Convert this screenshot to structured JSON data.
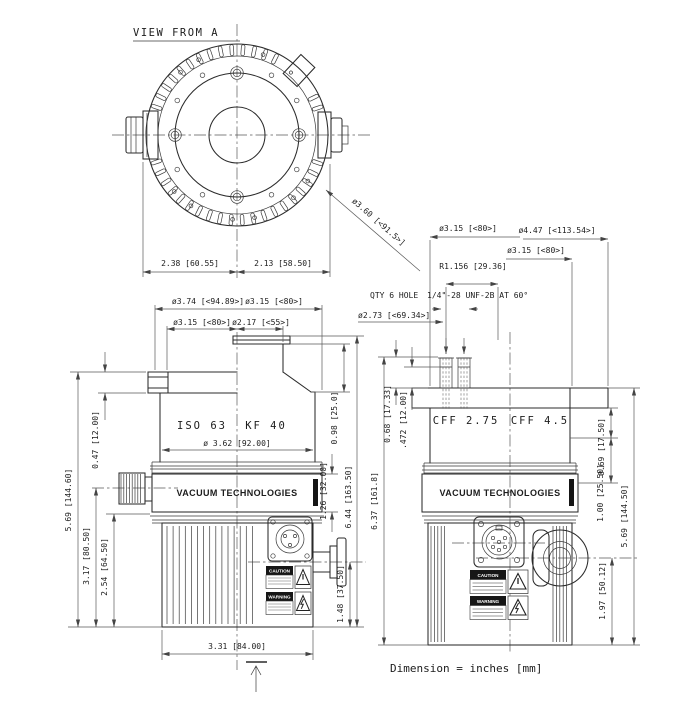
{
  "title": "VIEW FROM A",
  "note": "Dimension = inches [mm]",
  "top_view": {
    "dim_left": "2.38 [60.55]",
    "dim_right": "2.13 [58.50]",
    "dia_leader": "ø3.60 [<91.5>]"
  },
  "left_view": {
    "flange_left": "ISO 63",
    "flange_right": "KF 40",
    "brand": "VACUUM TECHNOLOGIES",
    "dims": {
      "dia_flange_od": "ø3.74 [<94.89>]",
      "dia_neck": "ø3.15 [<80>]",
      "dia_flange_bc": "ø3.15 [<80>]",
      "dia_kf_tube": "ø2.17 [<55>]",
      "dia_body": "ø 3.62 [92.00]",
      "height_total": "5.69 [144.60]",
      "flange_thickness": "0.47 [12.00]",
      "height_vent_port": "3.17 [80.50]",
      "height_motor": "2.54 [64.50]",
      "height_side_port": "1.48 [37.50]",
      "width_base": "3.31 [84.00]",
      "height_neck": "0.98 [25.0]",
      "height_band": "1.26 [32.00]",
      "height_body": "6.44 [163.50]"
    },
    "labels": {
      "caution": "CAUTION",
      "warning": "WARNING"
    }
  },
  "right_view": {
    "flange_left": "CFF 2.75",
    "flange_right": "CFF 4.5",
    "brand": "VACUUM TECHNOLOGIES",
    "dims": {
      "dia_bolt_top": "ø3.15 [<80>]",
      "dia_flange_od": "ø4.47 [<113.54>]",
      "dia_flange_bc": "ø3.15 [<80>]",
      "radius_bolt": "R1.156 [29.36]",
      "holes_qty": "QTY 6 HOLE",
      "holes_spec": "1/4\"-28 UNF-2B AT 60°",
      "dia_bolt_circle": "ø2.73 [<69.34>]",
      "stud_height": "0.68 [17.33]",
      "thread_depth": ".472 [12.00]",
      "height_total_left": "6.37 [161.8]",
      "flange_step1": "0.69 [17.50]",
      "flange_step2": "1.00 [25.50]",
      "height_total_right": "5.69 [144.50]",
      "height_side_port": "1.97 [50.12]"
    },
    "labels": {
      "caution": "CAUTION",
      "warning": "WARNING"
    }
  }
}
